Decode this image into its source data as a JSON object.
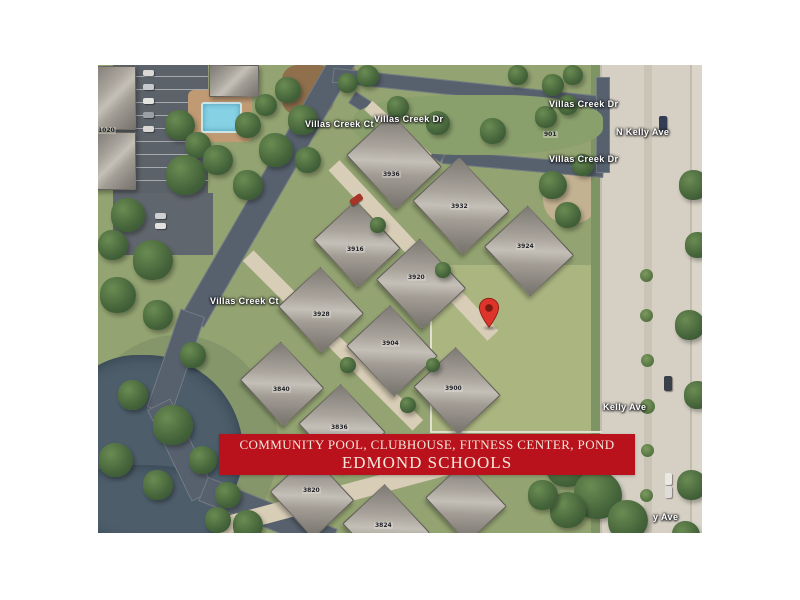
{
  "window": {
    "background_color": "#ffffff"
  },
  "banner": {
    "line1": "COMMUNITY POOL, CLUBHOUSE, FITNESS CENTER, POND",
    "line2": "EDMOND SCHOOLS",
    "background_color": "#b9121c",
    "text_color": "#f4e6da"
  },
  "map": {
    "type": "satellite-aerial-photo",
    "pin": {
      "name": "location-pin",
      "color": "#dd342c",
      "dot_color": "#7c1a10"
    },
    "colors": {
      "grass": "#93a371",
      "vacant_lot": "#aab580",
      "asphalt_road": "#57616e",
      "concrete_road": "#d6d0c4",
      "driveway": "#d8cdb6",
      "pond_water": "#4d5d6a",
      "pool_water": "#86d2e4",
      "roof": "#a9a49c",
      "tree": "#44633a"
    },
    "street_labels": [
      {
        "text": "Villas Creek Ct",
        "x": 207,
        "y": 54,
        "rot": -58
      },
      {
        "text": "Villas Creek Dr",
        "x": 276,
        "y": 49,
        "rot": 27
      },
      {
        "text": "Villas Creek Dr",
        "x": 451,
        "y": 34,
        "rot": 0
      },
      {
        "text": "Villas Creek Dr",
        "x": 451,
        "y": 89,
        "rot": 0
      },
      {
        "text": "N Kelly Ave",
        "x": 518,
        "y": 62,
        "rot": -90
      },
      {
        "text": "Villas Creek Ct",
        "x": 112,
        "y": 231,
        "rot": -60
      },
      {
        "text": "Kelly Ave",
        "x": 505,
        "y": 337,
        "rot": -90
      },
      {
        "text": "y Ave",
        "x": 555,
        "y": 447,
        "rot": -90
      }
    ],
    "house_numbers": [
      {
        "text": "1020",
        "x": -1,
        "y": 62
      },
      {
        "text": "3936",
        "x": 284,
        "y": 106
      },
      {
        "text": "3932",
        "x": 352,
        "y": 138
      },
      {
        "text": "3916",
        "x": 248,
        "y": 181
      },
      {
        "text": "3920",
        "x": 309,
        "y": 209
      },
      {
        "text": "3924",
        "x": 418,
        "y": 178
      },
      {
        "text": "3928",
        "x": 214,
        "y": 246
      },
      {
        "text": "3904",
        "x": 283,
        "y": 275
      },
      {
        "text": "3900",
        "x": 346,
        "y": 320
      },
      {
        "text": "3840",
        "x": 174,
        "y": 321
      },
      {
        "text": "3836",
        "x": 232,
        "y": 359
      },
      {
        "text": "3820",
        "x": 204,
        "y": 422
      },
      {
        "text": "3824",
        "x": 276,
        "y": 457
      },
      {
        "text": "901",
        "x": 445,
        "y": 66
      }
    ],
    "decor": [
      {
        "c": "zone",
        "n": "grass-bank",
        "x": -20,
        "y": 270,
        "w": 200,
        "h": 220,
        "bg": "#85976a",
        "br": "50%"
      },
      {
        "c": "zone",
        "n": "vacant-lot-grass",
        "x": 332,
        "y": 200,
        "w": 172,
        "h": 168,
        "bg": "#aab580"
      },
      {
        "c": "zone",
        "n": "dirt-patch",
        "x": 445,
        "y": 98,
        "w": 55,
        "h": 60,
        "bg": "#c3b291",
        "br": "40%"
      },
      {
        "c": "zone",
        "n": "mulch-bed",
        "x": 184,
        "y": 0,
        "w": 52,
        "h": 50,
        "bg": "#8f6f4c",
        "br": "30%"
      },
      {
        "c": "zone",
        "n": "mulch-bed",
        "x": 228,
        "y": 0,
        "w": 30,
        "h": 26,
        "bg": "#9a7854",
        "br": "30%"
      },
      {
        "c": "zone park",
        "n": "parking-lot",
        "x": 15,
        "y": 0,
        "w": 95,
        "h": 128
      },
      {
        "c": "zone",
        "n": "parking-lot",
        "x": 15,
        "y": 128,
        "w": 100,
        "h": 62,
        "bg": "#60666d"
      },
      {
        "c": "zone",
        "n": "pool-deck",
        "x": 90,
        "y": 25,
        "w": 64,
        "h": 52,
        "bg": "#c09a72",
        "br": "6px"
      },
      {
        "c": "pool",
        "n": "swimming-pool",
        "x": 103,
        "y": 37,
        "w": 37,
        "h": 27
      },
      {
        "c": "water",
        "n": "pond",
        "x": -40,
        "y": 290,
        "w": 185,
        "h": 185,
        "bg": "#4d5d6a",
        "br": "45% 55% 50% 40%"
      },
      {
        "c": "water",
        "n": "pond",
        "x": -20,
        "y": 400,
        "w": 165,
        "h": 80,
        "bg": "#4d5d6a",
        "br": "30% 60% 20% 40%"
      },
      {
        "c": "zone",
        "n": "roadside-verge",
        "x": 493,
        "y": 0,
        "w": 9,
        "h": 468,
        "bg": "#7f9464"
      },
      {
        "c": "zone",
        "n": "roadside-strip",
        "x": 595,
        "y": 0,
        "w": 9,
        "h": 468,
        "bg": "#5f7a4d"
      },
      {
        "c": "zone",
        "n": "dirt-shoulder",
        "x": 585,
        "y": 18,
        "w": 19,
        "h": 75,
        "bg": "#c7b795"
      },
      {
        "c": "kelly",
        "n": "n-kelly-ave-road",
        "x": 502,
        "y": 0,
        "w": 102,
        "h": 468
      },
      {
        "c": "road",
        "n": "villas-creek-ct-road",
        "x": 17,
        "y": 109,
        "w": 310,
        "h": 26,
        "r": 120
      },
      {
        "c": "road",
        "n": "villas-creek-ct-road",
        "x": 26,
        "y": 284,
        "w": 104,
        "h": 26,
        "r": 109
      },
      {
        "c": "road",
        "n": "villas-creek-ct-road",
        "x": 32,
        "y": 372,
        "w": 102,
        "h": 26,
        "r": 64
      },
      {
        "c": "road",
        "n": "villas-creek-ct-road",
        "x": 100,
        "y": 437,
        "w": 140,
        "h": 26,
        "r": 22
      },
      {
        "c": "road",
        "n": "villas-creek-dr-road",
        "x": 234,
        "y": 17,
        "w": 272,
        "h": 15,
        "r": 6
      },
      {
        "c": "road",
        "n": "villas-creek-dr-road",
        "x": 344,
        "y": 92,
        "w": 162,
        "h": 14,
        "r": 5
      },
      {
        "c": "road",
        "n": "villas-creek-dr-road",
        "x": 245,
        "y": 55,
        "w": 110,
        "h": 14,
        "r": 33
      },
      {
        "c": "road",
        "n": "entrance-apron",
        "x": 498,
        "y": 12,
        "w": 14,
        "h": 96
      },
      {
        "c": "zone median",
        "n": "entrance-median-island",
        "x": 255,
        "y": 30,
        "w": 250,
        "h": 60,
        "bg": "#8aa06c",
        "br": "40% 40% 45% 45%"
      },
      {
        "c": "drive",
        "n": "driveway",
        "x": 199,
        "y": 178,
        "w": 233,
        "h": 15,
        "r": 47
      },
      {
        "c": "drive",
        "n": "driveway",
        "x": 115,
        "y": 268,
        "w": 240,
        "h": 15,
        "r": 45
      },
      {
        "c": "drive",
        "n": "driveway",
        "x": 115,
        "y": 412,
        "w": 320,
        "h": 18,
        "r": -15
      },
      {
        "c": "drive",
        "n": "driveway",
        "x": 260,
        "y": 61,
        "w": 80,
        "h": 12,
        "r": 42
      },
      {
        "c": "fence",
        "n": "lot-fence-line",
        "x": 332,
        "y": 200,
        "w": 2,
        "h": 168,
        "bg": "#e3e0d2"
      },
      {
        "c": "fence",
        "n": "lot-fence-line",
        "x": 332,
        "y": 366,
        "w": 172,
        "h": 2,
        "bg": "#e3e0d2"
      },
      {
        "c": "house",
        "n": "clubhouse-roof",
        "x": 111,
        "y": 0,
        "w": 48,
        "h": 30
      },
      {
        "c": "house",
        "n": "building-roof",
        "x": -8,
        "y": 1,
        "w": 44,
        "h": 62
      },
      {
        "c": "house",
        "n": "building-roof",
        "x": -4,
        "y": 67,
        "w": 40,
        "h": 56
      },
      {
        "c": "house",
        "n": "house-roof",
        "x": 259,
        "y": 65,
        "w": 72,
        "h": 60,
        "r": 47
      },
      {
        "c": "house",
        "n": "house-roof",
        "x": 326,
        "y": 109,
        "w": 72,
        "h": 62,
        "r": 47
      },
      {
        "c": "house",
        "n": "house-roof",
        "x": 397,
        "y": 156,
        "w": 66,
        "h": 58,
        "r": 47
      },
      {
        "c": "house",
        "n": "house-roof",
        "x": 226,
        "y": 150,
        "w": 64,
        "h": 56,
        "r": 47
      },
      {
        "c": "house",
        "n": "house-roof",
        "x": 289,
        "y": 189,
        "w": 66,
        "h": 58,
        "r": 47
      },
      {
        "c": "house",
        "n": "house-roof",
        "x": 191,
        "y": 216,
        "w": 62,
        "h": 56,
        "r": 47
      },
      {
        "c": "house",
        "n": "house-roof",
        "x": 259,
        "y": 256,
        "w": 68,
        "h": 58,
        "r": 47
      },
      {
        "c": "house",
        "n": "house-roof",
        "x": 326,
        "y": 297,
        "w": 64,
        "h": 56,
        "r": 47
      },
      {
        "c": "house",
        "n": "house-roof",
        "x": 152,
        "y": 291,
        "w": 62,
        "h": 54,
        "r": 47
      },
      {
        "c": "house",
        "n": "house-roof",
        "x": 211,
        "y": 334,
        "w": 64,
        "h": 56,
        "r": 47
      },
      {
        "c": "house",
        "n": "house-roof",
        "x": 182,
        "y": 403,
        "w": 62,
        "h": 54,
        "r": 47
      },
      {
        "c": "house",
        "n": "house-roof",
        "x": 255,
        "y": 434,
        "w": 64,
        "h": 56,
        "r": 47
      },
      {
        "c": "house",
        "n": "house-roof",
        "x": 337,
        "y": 410,
        "w": 60,
        "h": 52,
        "r": 47
      },
      {
        "c": "tree",
        "n": "tree",
        "x": 13,
        "y": 133,
        "w": 34,
        "h": 34
      },
      {
        "c": "tree",
        "n": "tree",
        "x": 0,
        "y": 165,
        "w": 30,
        "h": 30
      },
      {
        "c": "tree",
        "n": "tree",
        "x": 35,
        "y": 175,
        "w": 40,
        "h": 40
      },
      {
        "c": "tree",
        "n": "tree",
        "x": 2,
        "y": 212,
        "w": 36,
        "h": 36
      },
      {
        "c": "tree",
        "n": "tree",
        "x": 45,
        "y": 235,
        "w": 30,
        "h": 30
      },
      {
        "c": "tree",
        "n": "tree",
        "x": 82,
        "y": 277,
        "w": 26,
        "h": 26
      },
      {
        "c": "tree",
        "n": "tree",
        "x": 20,
        "y": 315,
        "w": 30,
        "h": 30
      },
      {
        "c": "tree",
        "n": "tree",
        "x": 55,
        "y": 340,
        "w": 40,
        "h": 40
      },
      {
        "c": "tree",
        "n": "tree",
        "x": 1,
        "y": 378,
        "w": 34,
        "h": 34
      },
      {
        "c": "tree",
        "n": "tree",
        "x": 45,
        "y": 405,
        "w": 30,
        "h": 30
      },
      {
        "c": "tree",
        "n": "tree",
        "x": 91,
        "y": 381,
        "w": 28,
        "h": 28
      },
      {
        "c": "tree",
        "n": "tree",
        "x": 117,
        "y": 417,
        "w": 26,
        "h": 26
      },
      {
        "c": "tree",
        "n": "tree",
        "x": 67,
        "y": 45,
        "w": 30,
        "h": 30
      },
      {
        "c": "tree",
        "n": "tree",
        "x": 87,
        "y": 67,
        "w": 26,
        "h": 26
      },
      {
        "c": "tree",
        "n": "tree",
        "x": 68,
        "y": 90,
        "w": 40,
        "h": 40
      },
      {
        "c": "tree",
        "n": "tree",
        "x": 105,
        "y": 80,
        "w": 30,
        "h": 30
      },
      {
        "c": "tree",
        "n": "tree",
        "x": 137,
        "y": 47,
        "w": 26,
        "h": 26
      },
      {
        "c": "tree",
        "n": "tree",
        "x": 157,
        "y": 29,
        "w": 22,
        "h": 22
      },
      {
        "c": "tree",
        "n": "tree",
        "x": 177,
        "y": 12,
        "w": 26,
        "h": 26
      },
      {
        "c": "tree",
        "n": "tree",
        "x": 190,
        "y": 40,
        "w": 30,
        "h": 30
      },
      {
        "c": "tree",
        "n": "tree",
        "x": 161,
        "y": 68,
        "w": 34,
        "h": 34
      },
      {
        "c": "tree",
        "n": "tree",
        "x": 135,
        "y": 105,
        "w": 30,
        "h": 30
      },
      {
        "c": "tree",
        "n": "tree",
        "x": 197,
        "y": 82,
        "w": 26,
        "h": 26
      },
      {
        "c": "tree",
        "n": "tree",
        "x": 289,
        "y": 31,
        "w": 22,
        "h": 22
      },
      {
        "c": "tree",
        "n": "tree",
        "x": 328,
        "y": 46,
        "w": 24,
        "h": 24
      },
      {
        "c": "tree",
        "n": "tree",
        "x": 382,
        "y": 53,
        "w": 26,
        "h": 26
      },
      {
        "c": "tree",
        "n": "tree",
        "x": 437,
        "y": 41,
        "w": 22,
        "h": 22
      },
      {
        "c": "tree",
        "n": "tree",
        "x": 460,
        "y": 30,
        "w": 20,
        "h": 20
      },
      {
        "c": "tree",
        "n": "tree",
        "x": 240,
        "y": 8,
        "w": 20,
        "h": 20
      },
      {
        "c": "tree",
        "n": "tree",
        "x": 259,
        "y": 0,
        "w": 22,
        "h": 22
      },
      {
        "c": "tree",
        "n": "tree",
        "x": 410,
        "y": 0,
        "w": 20,
        "h": 20
      },
      {
        "c": "tree",
        "n": "tree",
        "x": 444,
        "y": 9,
        "w": 22,
        "h": 22
      },
      {
        "c": "tree",
        "n": "tree",
        "x": 465,
        "y": 0,
        "w": 20,
        "h": 20
      },
      {
        "c": "tree",
        "n": "tree",
        "x": 441,
        "y": 106,
        "w": 28,
        "h": 28
      },
      {
        "c": "tree",
        "n": "tree",
        "x": 457,
        "y": 137,
        "w": 26,
        "h": 26
      },
      {
        "c": "tree",
        "n": "tree",
        "x": 474,
        "y": 89,
        "w": 22,
        "h": 22
      },
      {
        "c": "tree",
        "n": "tree",
        "x": 581,
        "y": 105,
        "w": 30,
        "h": 30
      },
      {
        "c": "tree",
        "n": "tree",
        "x": 587,
        "y": 167,
        "w": 26,
        "h": 26
      },
      {
        "c": "tree",
        "n": "tree",
        "x": 577,
        "y": 245,
        "w": 30,
        "h": 30
      },
      {
        "c": "tree",
        "n": "tree",
        "x": 586,
        "y": 316,
        "w": 28,
        "h": 28
      },
      {
        "c": "tree",
        "n": "tree",
        "x": 579,
        "y": 405,
        "w": 30,
        "h": 30
      },
      {
        "c": "tree",
        "n": "tree",
        "x": 574,
        "y": 456,
        "w": 28,
        "h": 28
      },
      {
        "c": "tree",
        "n": "tree",
        "x": 448,
        "y": 378,
        "w": 44,
        "h": 44
      },
      {
        "c": "tree",
        "n": "tree",
        "x": 476,
        "y": 406,
        "w": 48,
        "h": 48
      },
      {
        "c": "tree",
        "n": "tree",
        "x": 510,
        "y": 435,
        "w": 40,
        "h": 40
      },
      {
        "c": "tree",
        "n": "tree",
        "x": 452,
        "y": 427,
        "w": 36,
        "h": 36
      },
      {
        "c": "tree",
        "n": "tree",
        "x": 430,
        "y": 415,
        "w": 30,
        "h": 30
      },
      {
        "c": "tree",
        "n": "tree",
        "x": 272,
        "y": 152,
        "w": 16,
        "h": 16
      },
      {
        "c": "tree",
        "n": "tree",
        "x": 337,
        "y": 197,
        "w": 16,
        "h": 16
      },
      {
        "c": "tree",
        "n": "tree",
        "x": 242,
        "y": 292,
        "w": 16,
        "h": 16
      },
      {
        "c": "tree",
        "n": "tree",
        "x": 302,
        "y": 332,
        "w": 16,
        "h": 16
      },
      {
        "c": "tree",
        "n": "tree",
        "x": 207,
        "y": 377,
        "w": 16,
        "h": 16
      },
      {
        "c": "tree",
        "n": "tree",
        "x": 328,
        "y": 293,
        "w": 14,
        "h": 14
      },
      {
        "c": "tree",
        "n": "tree",
        "x": 135,
        "y": 445,
        "w": 30,
        "h": 30
      },
      {
        "c": "tree",
        "n": "tree",
        "x": 107,
        "y": 442,
        "w": 26,
        "h": 26
      },
      {
        "c": "bush",
        "n": "median-bush",
        "x": 542,
        "y": 204,
        "w": 13,
        "h": 13
      },
      {
        "c": "bush",
        "n": "median-bush",
        "x": 542,
        "y": 244,
        "w": 13,
        "h": 13
      },
      {
        "c": "bush",
        "n": "median-bush",
        "x": 543,
        "y": 289,
        "w": 13,
        "h": 13
      },
      {
        "c": "bush",
        "n": "median-bush",
        "x": 542,
        "y": 334,
        "w": 15,
        "h": 15
      },
      {
        "c": "bush",
        "n": "median-bush",
        "x": 543,
        "y": 379,
        "w": 13,
        "h": 13
      },
      {
        "c": "bush",
        "n": "median-bush",
        "x": 542,
        "y": 424,
        "w": 13,
        "h": 13
      },
      {
        "c": "car",
        "n": "parked-car",
        "x": 45,
        "y": 5,
        "w": 11,
        "h": 6,
        "bg": "#dad9d5"
      },
      {
        "c": "car",
        "n": "parked-car",
        "x": 45,
        "y": 19,
        "w": 11,
        "h": 6,
        "bg": "#c6cacf"
      },
      {
        "c": "car",
        "n": "parked-car",
        "x": 45,
        "y": 33,
        "w": 11,
        "h": 6,
        "bg": "#e4e4e0"
      },
      {
        "c": "car",
        "n": "parked-car",
        "x": 45,
        "y": 47,
        "w": 11,
        "h": 6,
        "bg": "#9aa0a6"
      },
      {
        "c": "car",
        "n": "parked-car",
        "x": 45,
        "y": 61,
        "w": 11,
        "h": 6,
        "bg": "#d9d8d4"
      },
      {
        "c": "car",
        "n": "parked-car",
        "x": 57,
        "y": 148,
        "w": 11,
        "h": 6,
        "bg": "#cfd0d2"
      },
      {
        "c": "car",
        "n": "parked-car",
        "x": 57,
        "y": 158,
        "w": 11,
        "h": 6,
        "bg": "#e2e1dd"
      },
      {
        "c": "car",
        "n": "red-car",
        "x": 255,
        "y": 128,
        "w": 7,
        "h": 13,
        "r": 55,
        "bg": "#a83428"
      },
      {
        "c": "car",
        "n": "car-on-road",
        "x": 561,
        "y": 51,
        "w": 8,
        "h": 15,
        "bg": "#323c55"
      },
      {
        "c": "car",
        "n": "car-on-road",
        "x": 566,
        "y": 311,
        "w": 8,
        "h": 15,
        "bg": "#3a4048"
      },
      {
        "c": "car",
        "n": "car-on-road",
        "x": 567,
        "y": 408,
        "w": 7,
        "h": 12,
        "bg": "#e9e8e3"
      },
      {
        "c": "car",
        "n": "car-on-road",
        "x": 567,
        "y": 421,
        "w": 7,
        "h": 12,
        "bg": "#dedcd7"
      }
    ]
  }
}
